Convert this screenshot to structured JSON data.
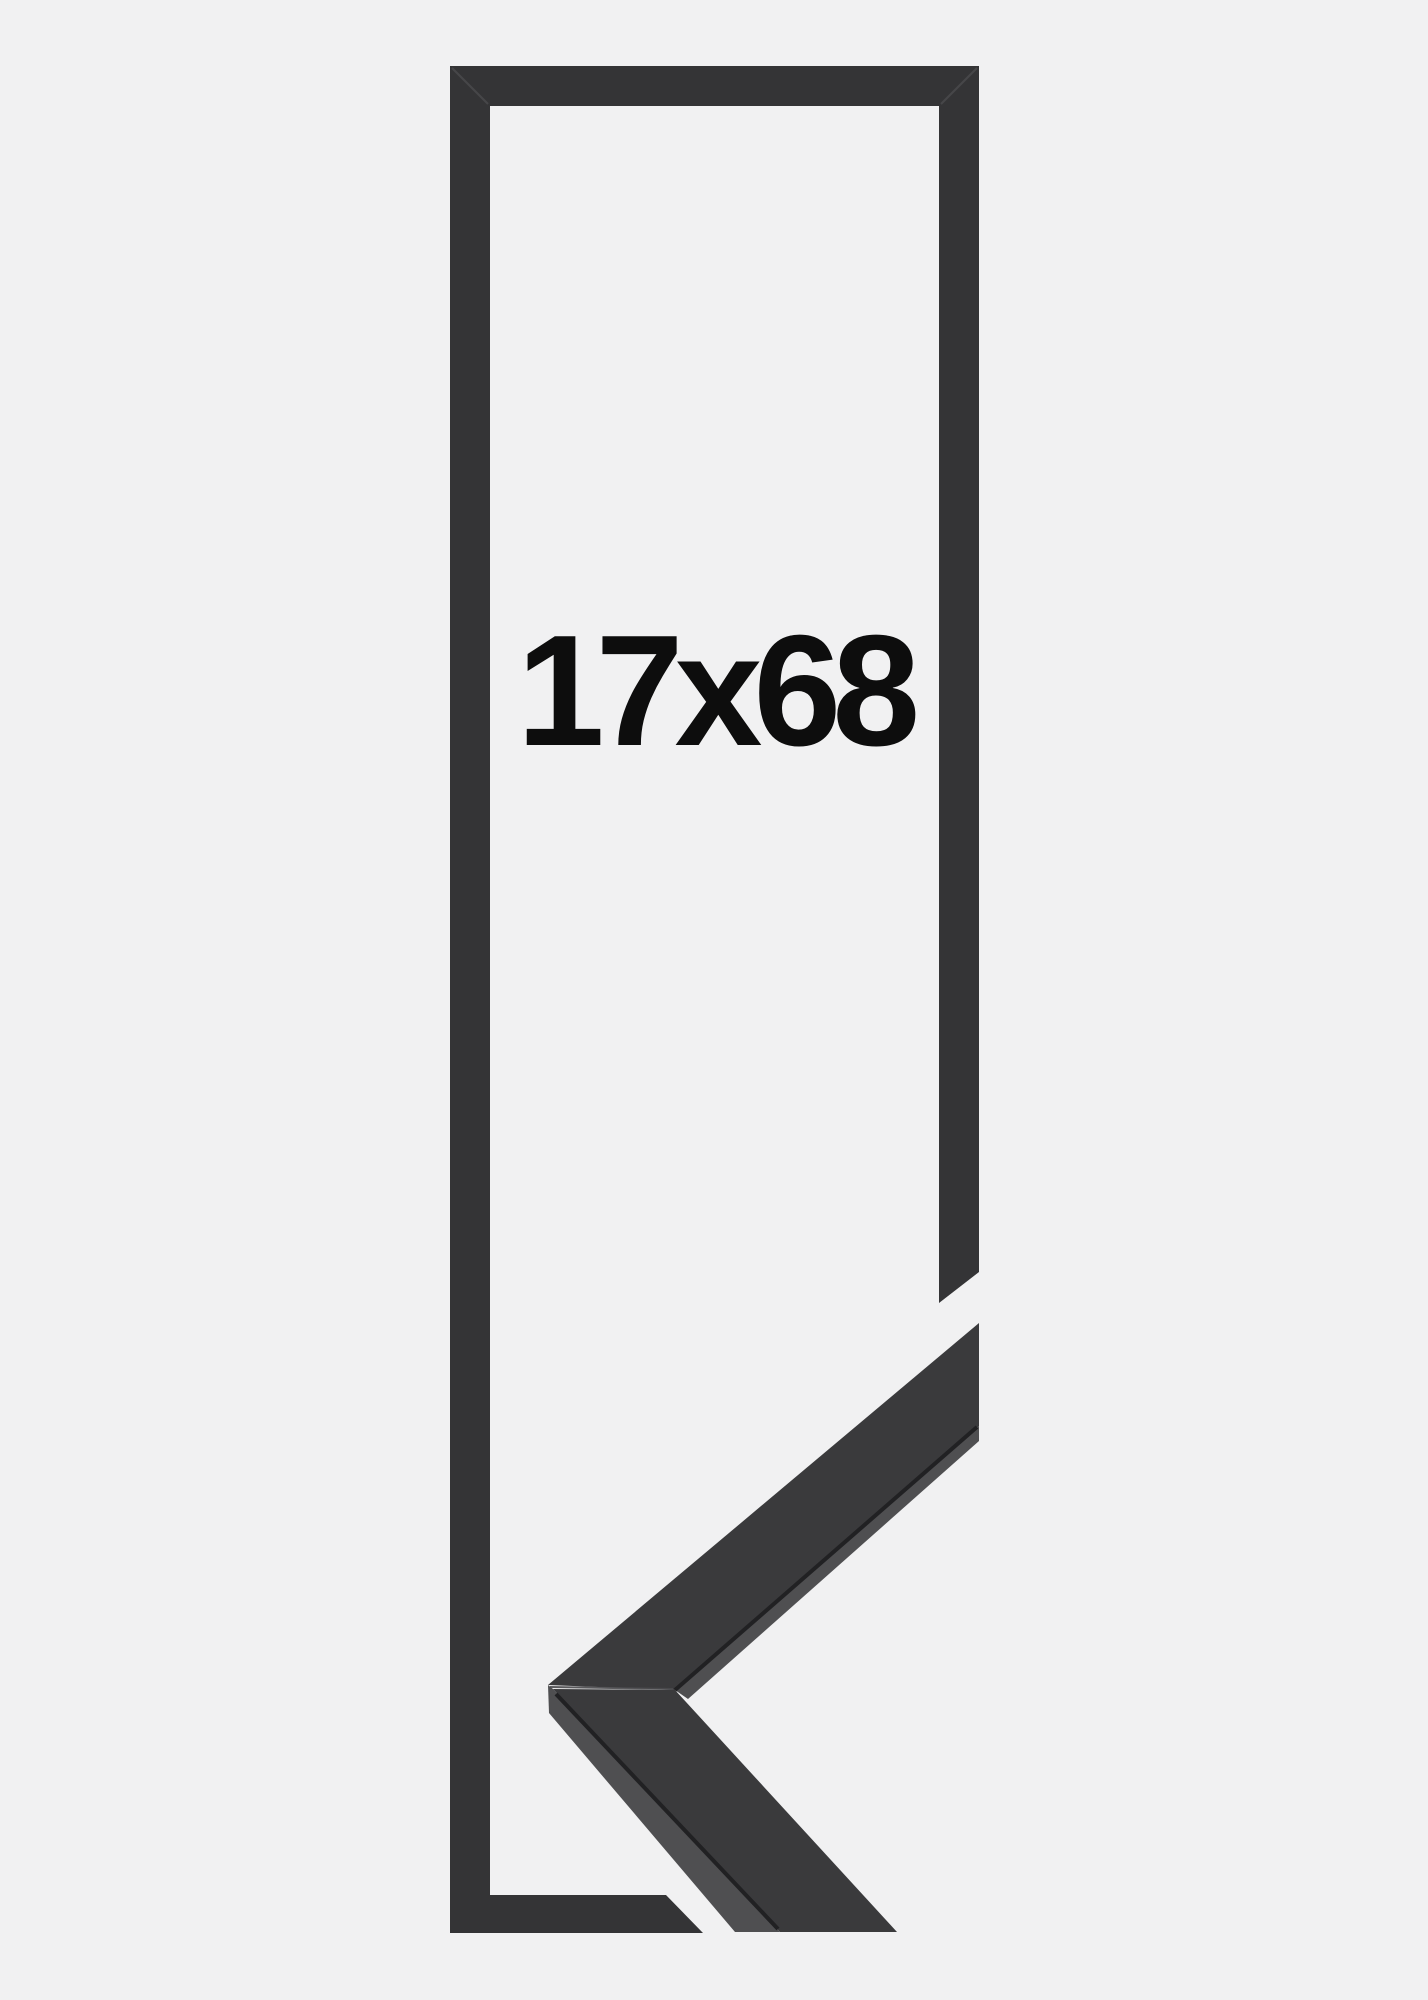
{
  "size_label": "17x68",
  "colors": {
    "background": "#f1f1f2",
    "frame": "#343436",
    "frame_seam": "#4a4a4d",
    "corner_face": "#3a3a3c",
    "corner_edge": "#4f4f51",
    "corner_crease": "#212123",
    "label_text": "#0d0d0d"
  }
}
